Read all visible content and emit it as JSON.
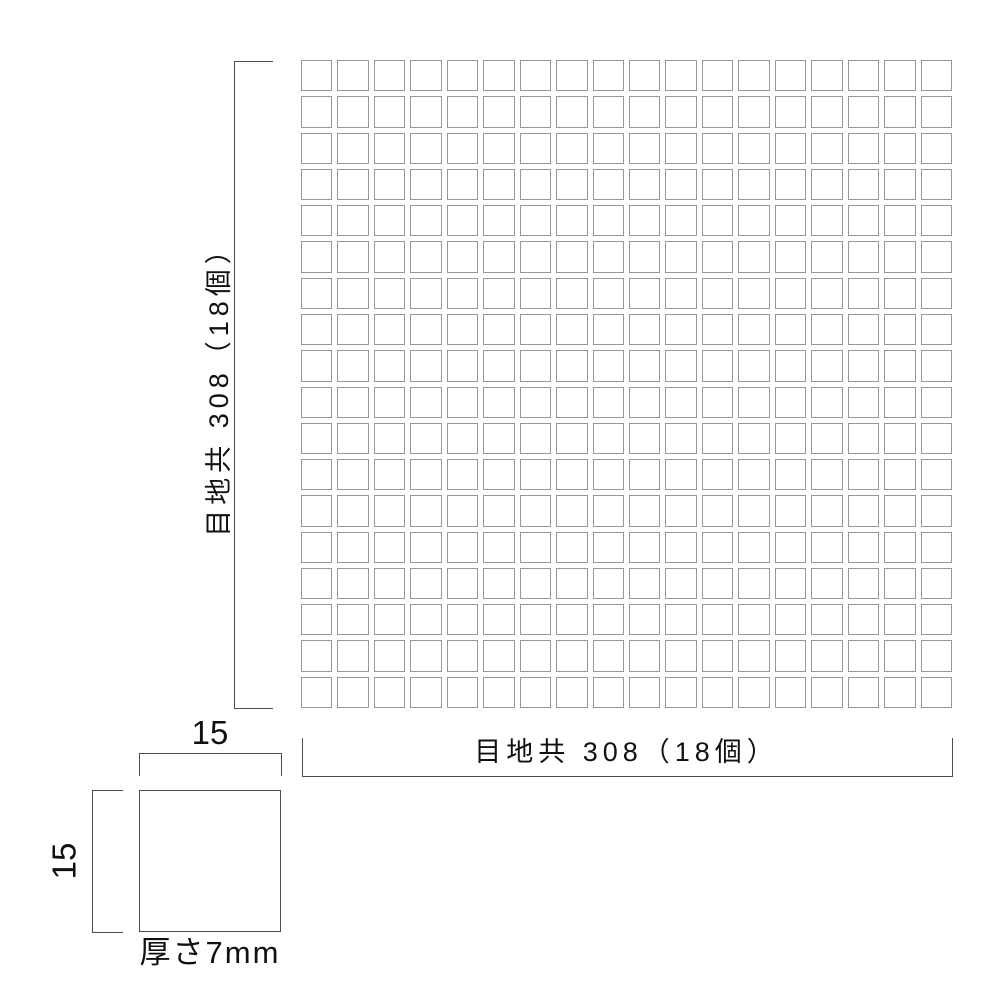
{
  "drawing": {
    "sheet": {
      "rows": 18,
      "cols": 18,
      "width_label": "目地共 308（18個）",
      "height_label": "目地共 308（18個）",
      "width_including_joints_mm": 308,
      "height_including_joints_mm": 308,
      "pieces_per_row": 18,
      "pieces_per_column": 18
    },
    "chip": {
      "width_label": "15",
      "height_label": "15",
      "width_mm": 15,
      "height_mm": 15,
      "thickness_label": "厚さ7mm",
      "thickness_mm": 7
    },
    "colors": {
      "background": "#ffffff",
      "tile_border": "#979797",
      "dimension_line": "#4d4d4d",
      "text": "#111111"
    }
  }
}
